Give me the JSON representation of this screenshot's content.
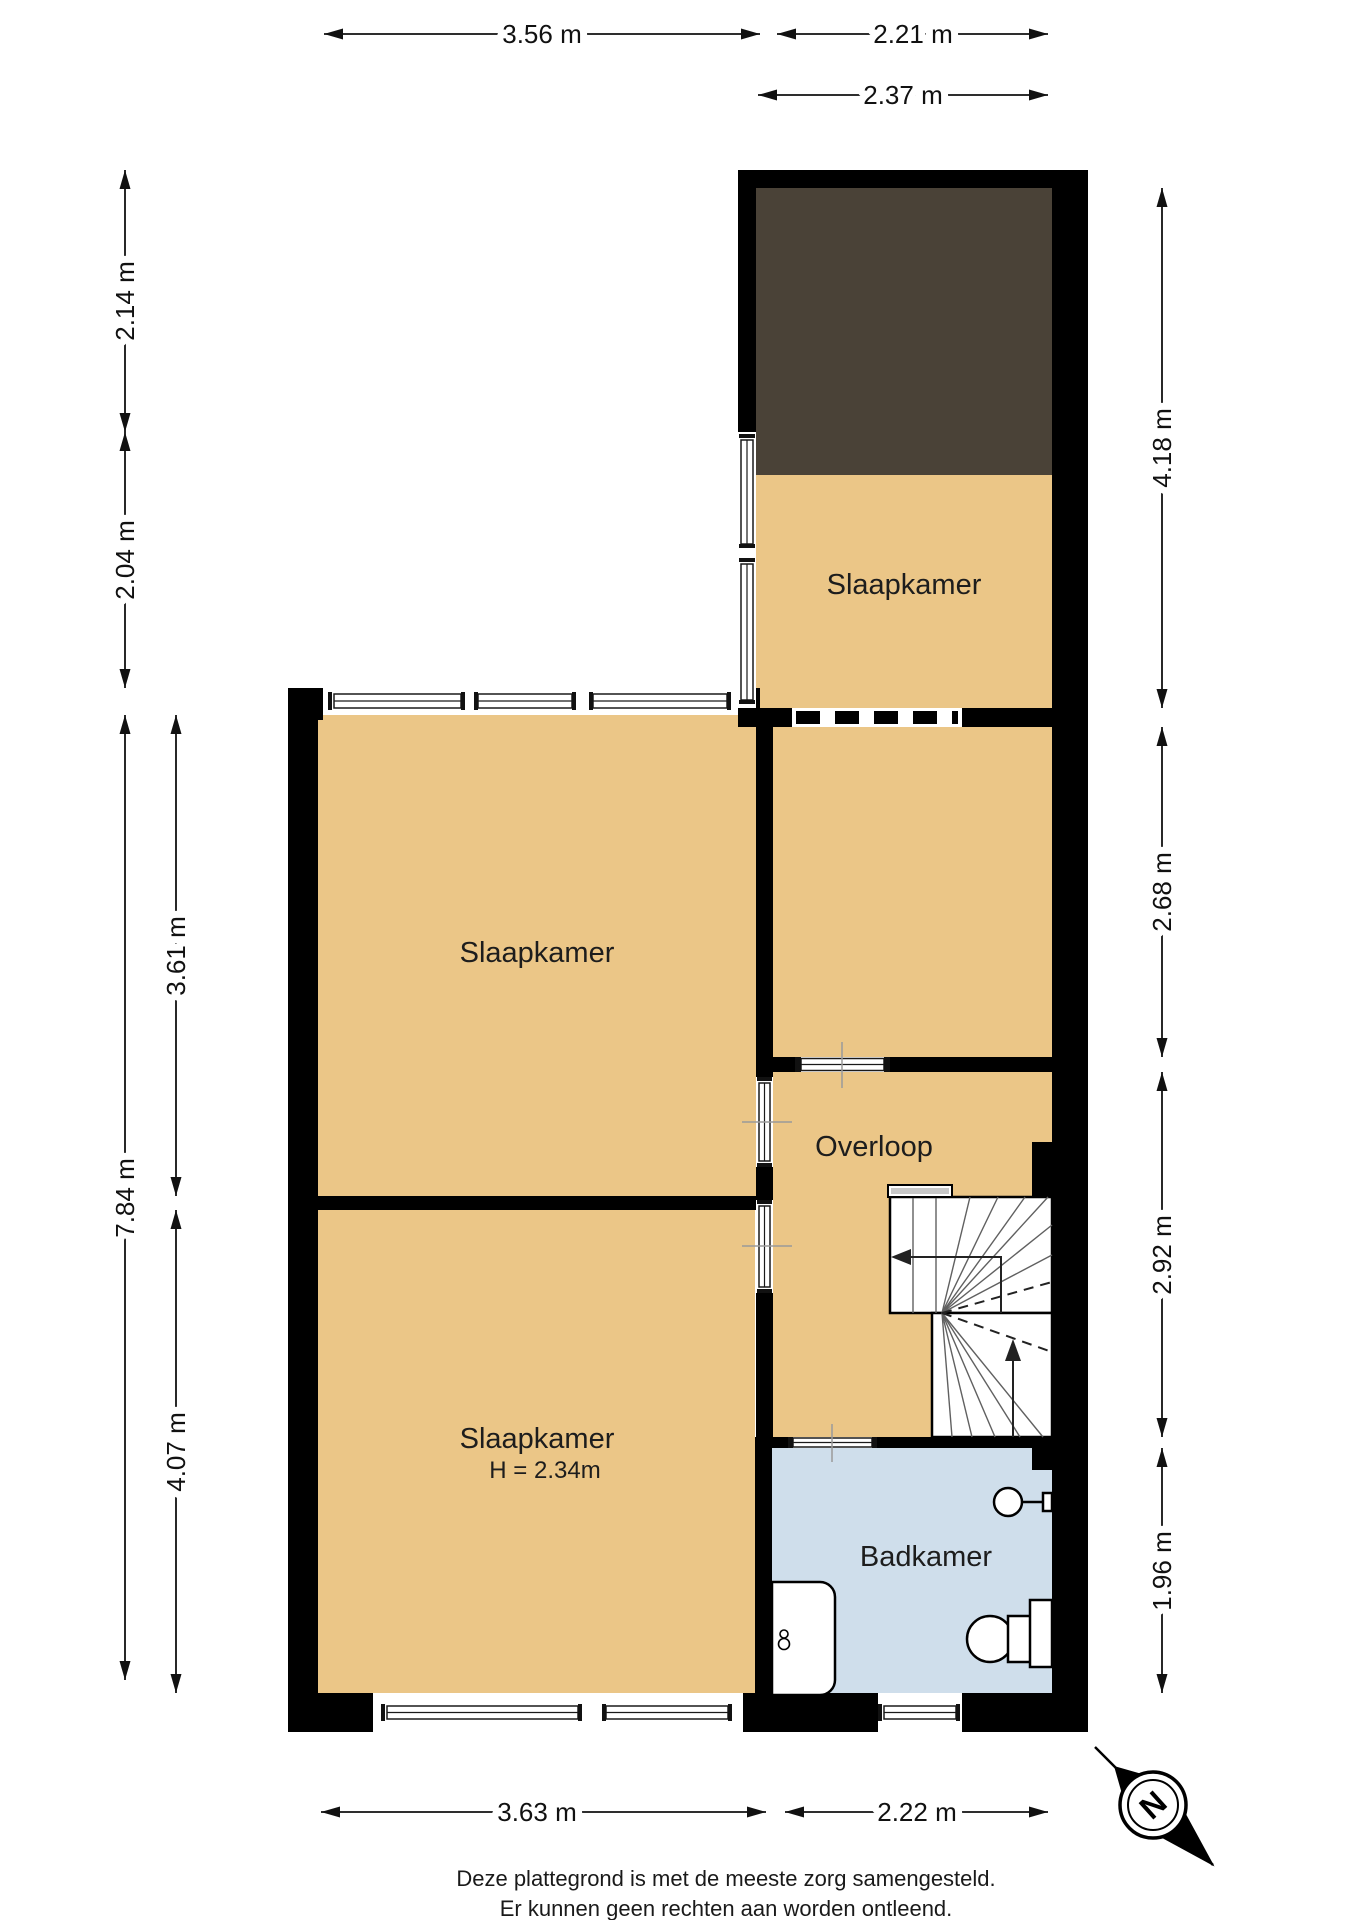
{
  "colors": {
    "paper": "#ffffff",
    "wall": "#000000",
    "room": "#ebc687",
    "roof": "#4a4237",
    "bath": "#cfdeeb"
  },
  "rooms": {
    "bedroom_top_right": "Slaapkamer",
    "bedroom_middle_left": "Slaapkamer",
    "bedroom_bottom_left": "Slaapkamer",
    "bedroom_bottom_left_height": "H = 2.34m",
    "landing": "Overloop",
    "bathroom": "Badkamer"
  },
  "dimensions": {
    "top_left_width": "3.56 m",
    "top_right_width": "2.21 m",
    "top_right_inner_width": "2.37 m",
    "left_upper": "2.14 m",
    "left_upper_lower": "2.04 m",
    "left_total": "7.84 m",
    "left_room_upper": "3.61 m",
    "left_room_lower": "4.07 m",
    "right_top": "4.18 m",
    "right_upper_middle": "2.68 m",
    "right_lower_middle": "2.92 m",
    "right_bottom": "1.96 m",
    "bottom_left_width": "3.63 m",
    "bottom_right_width": "2.22 m"
  },
  "compass": {
    "north": "N"
  },
  "footer": {
    "line1": "Deze plattegrond is met de meeste zorg samengesteld.",
    "line2": "Er kunnen geen rechten aan worden ontleend."
  }
}
